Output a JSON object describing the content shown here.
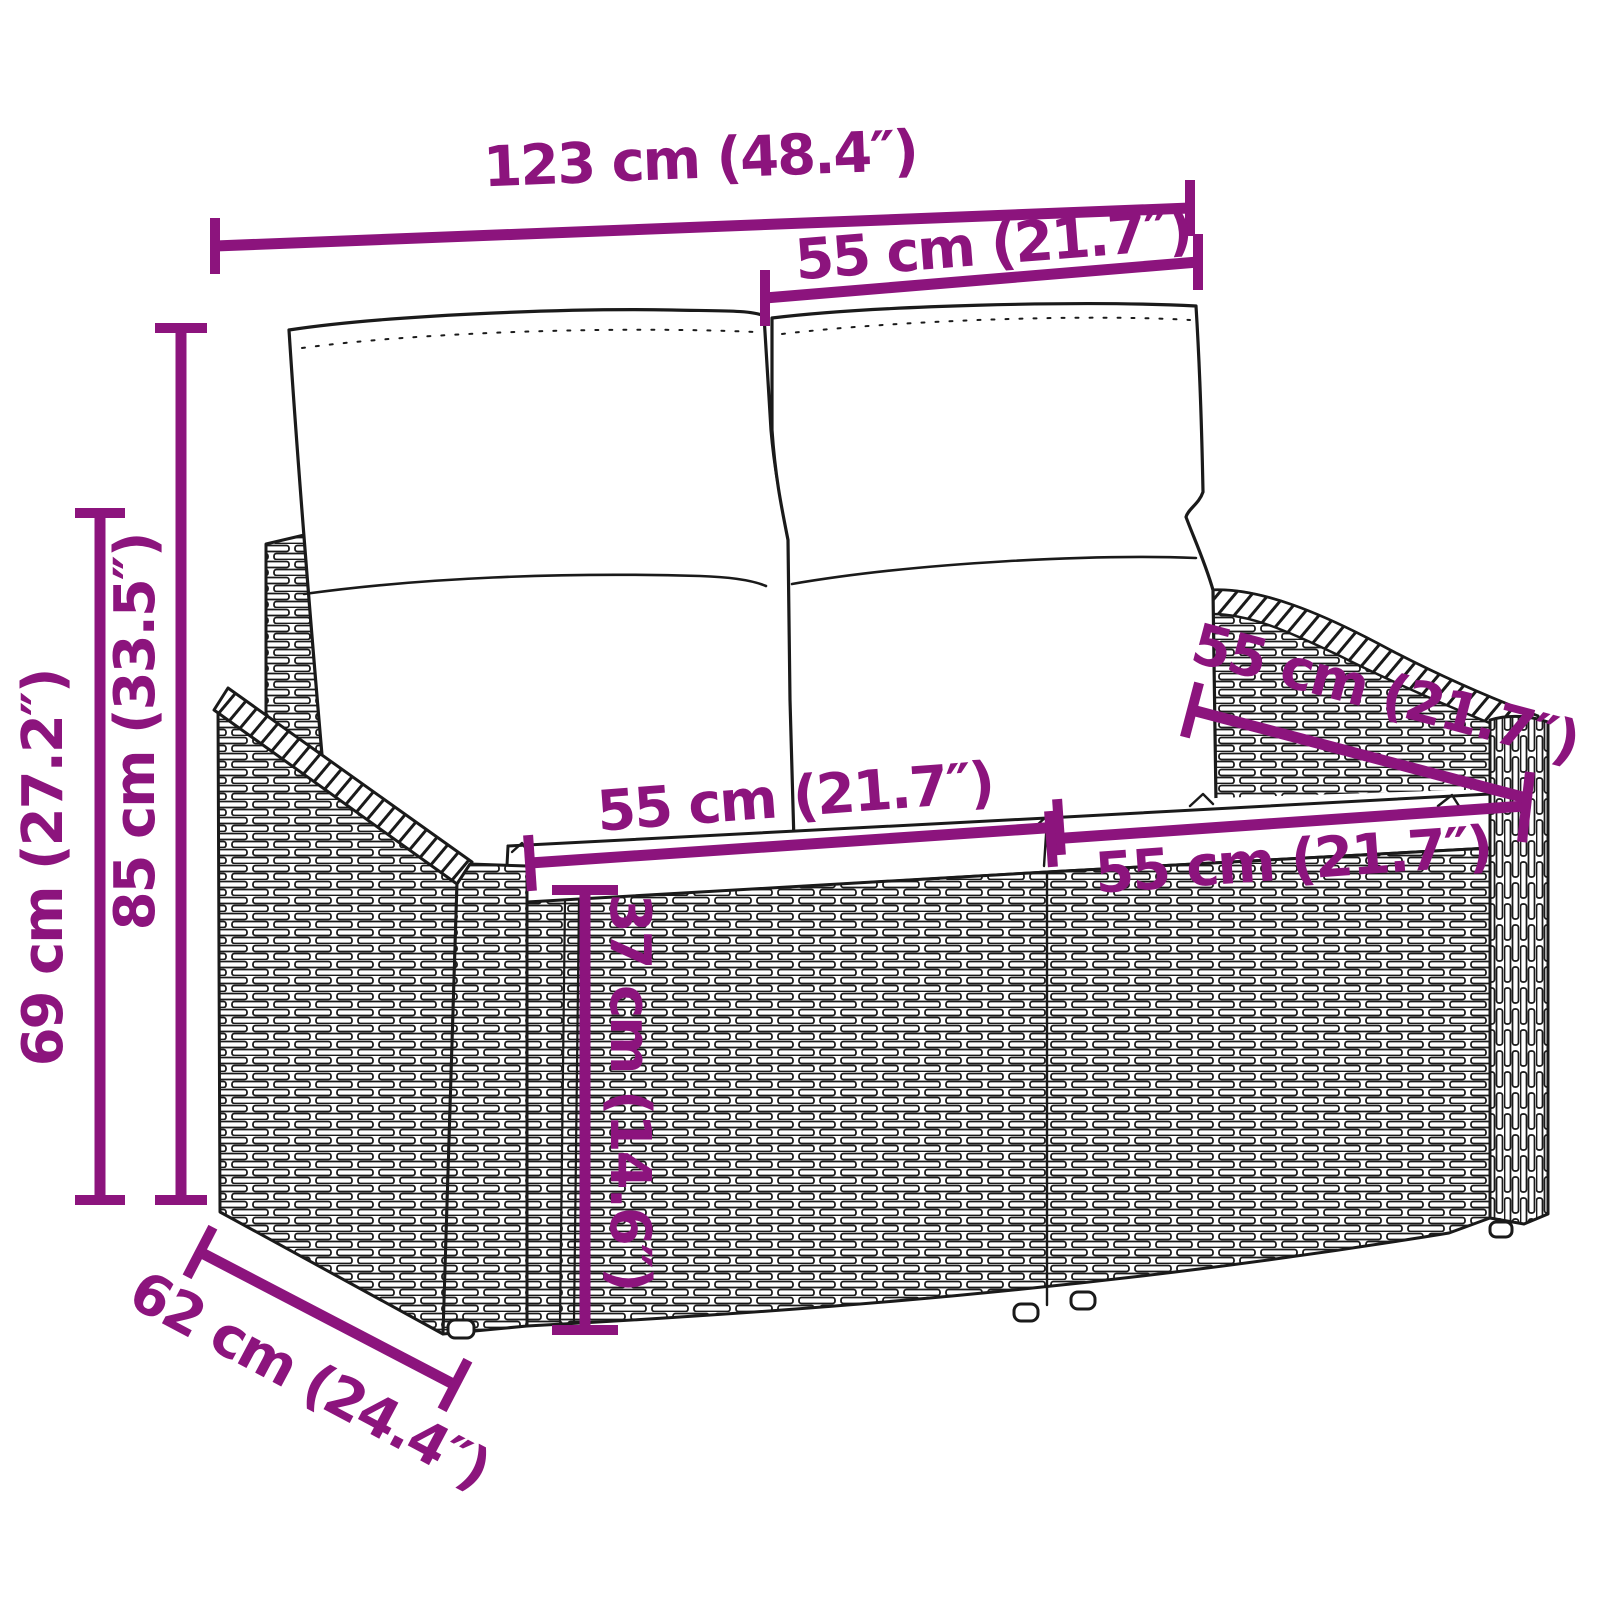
{
  "figure": {
    "type": "product-dimension-diagram",
    "subject": "poly rattan garden bench (2-seater) with back and seat cushions",
    "style": "black line drawing with woven rattan texture, magenta dimension lines"
  },
  "colors": {
    "dimension_accent": "#8C147D",
    "outline": "#1a1a1a",
    "background": "#ffffff"
  },
  "dimensions": [
    {
      "id": "overall-width",
      "label": "123 cm (48.4″)",
      "cm": "123 cm",
      "in": "48.4″"
    },
    {
      "id": "back-width",
      "label": "55 cm (21.7″)",
      "cm": "55 cm",
      "in": "21.7″"
    },
    {
      "id": "height-69",
      "label": "69 cm (27.2″)",
      "cm": "69 cm",
      "in": "27.2″"
    },
    {
      "id": "height-85",
      "label": "85 cm (33.5″)",
      "cm": "85 cm",
      "in": "33.5″"
    },
    {
      "id": "seat-width-left",
      "label": "55 cm (21.7″)",
      "cm": "55 cm",
      "in": "21.7″"
    },
    {
      "id": "seat-height",
      "label": "37 cm (14.6″)",
      "cm": "37 cm",
      "in": "14.6″"
    },
    {
      "id": "seat-depth",
      "label": "55 cm (21.7″)",
      "cm": "55 cm",
      "in": "21.7″"
    },
    {
      "id": "seat-width-right",
      "label": "55 cm (21.7″)",
      "cm": "55 cm",
      "in": "21.7″"
    },
    {
      "id": "overall-depth",
      "label": "62 cm (24.4″)",
      "cm": "62 cm",
      "in": "24.4″"
    }
  ]
}
